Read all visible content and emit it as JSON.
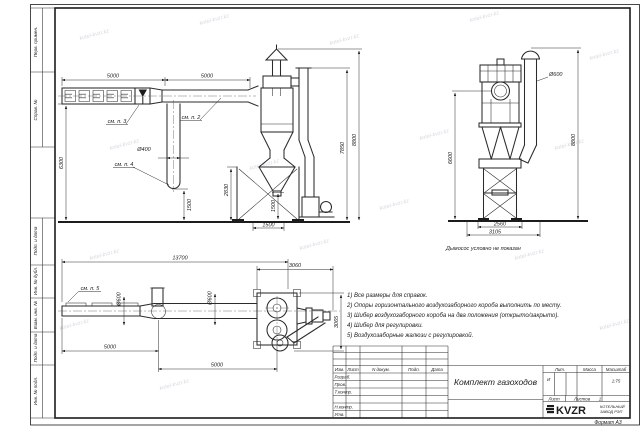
{
  "sheet": {
    "format": "Формат А3",
    "watermark": "kotel-kvzr.kz"
  },
  "margin_labels": {
    "top": [
      "Перв. примен.",
      "Справ. №"
    ],
    "bottom": [
      "Подп. и дата",
      "Инв. № дубл.",
      "Взам. инв. №",
      "Подп. и дата",
      "Инв. № подл."
    ]
  },
  "views": {
    "duct_elevation": {
      "dim_span_left": "5000",
      "dim_span_right": "5000",
      "dim_height": "6300",
      "dim_riser_diameter": "Ø400",
      "dim_riser_ground": "1500",
      "callout_damper": "см. п. 3",
      "callout_duct": "см. п. 2",
      "callout_elbow": "см. п. 4"
    },
    "cyclone_elevation": {
      "dim_support": "2830",
      "dim_support_inner": "1500",
      "dim_base": "1500",
      "dim_duct_top": "7850",
      "dim_chimney_top": "8800"
    },
    "battery_cyclone": {
      "dim_chimney_diameter": "Ø600",
      "dim_height_left": "6600",
      "dim_height_right": "8800",
      "dim_base_inner": "2560",
      "dim_base_outer": "3105",
      "caption": "Дымосос условно не показан"
    },
    "duct_plan": {
      "dim_total": "13700",
      "dim_cyclone_span": "3060",
      "dim_depth": "3065",
      "dim_d1": "Ø600",
      "dim_d2": "Ø600",
      "dim_span1": "5000",
      "dim_span2": "5000",
      "callout_louvers": "см. п. 5"
    }
  },
  "notes": {
    "items": [
      "1) Все размеры для справок.",
      "2) Опоры горизонтального воздухозаборного короба выполнить по месту.",
      "3) Шибер воздухозаборного короба на два положения (открыто/закрыто).",
      "4) Шибер для регулировки.",
      "5) Воздухозаборные жалюзи с регулировкой."
    ]
  },
  "title_block": {
    "title": "Комплект газоходов",
    "columns": [
      "Изм.",
      "Лист",
      "N докум.",
      "Подп.",
      "Дата"
    ],
    "row_labels": [
      "Разраб.",
      "Пров.",
      "Т.контр.",
      "Н.контр.",
      "Утв."
    ],
    "lit_label": "Лит.",
    "mass_label": "Масса",
    "scale_label": "Масштаб",
    "lit_value": "И",
    "scale_value": "1:75",
    "sheet_label": "Лист",
    "sheets_label": "Листов",
    "sheets_value": "1",
    "logo_text": "KVZR",
    "company_line1": "КОТЕЛЬНЫЙ",
    "company_line2": "ЗАВОД РЭП"
  }
}
